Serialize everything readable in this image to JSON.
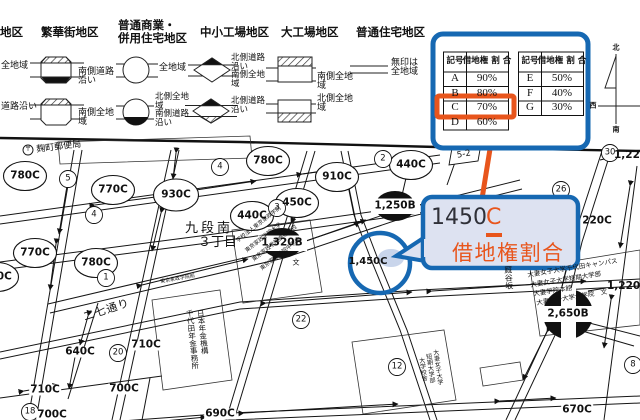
{
  "colors": {
    "accent_blue": "#1668b2",
    "accent_orange": "#e8551c",
    "callout_fill": "#dde2f1"
  },
  "legend": {
    "col0": {
      "title": "高度商業地区",
      "label_a": "全地域",
      "label_b": "道路沿い"
    },
    "col1": {
      "title": "繁華街地区",
      "label_a": "南側道路\n沿い",
      "label_b": "南側全地\n域"
    },
    "col2": {
      "title": "普通商業・\n併用住宅地区",
      "label_a": "全地域",
      "label_b": "北側全地\n域\n南側道路\n沿い"
    },
    "col3": {
      "title": "中小工場地区",
      "label_a": "北側道路\n沿い\n南側全地\n域",
      "label_b": "北側道路\n沿い"
    },
    "col4": {
      "title": "大工場地区",
      "label_a": "南側全地\n域",
      "label_b": "北側全地\n域"
    },
    "col5": {
      "title": "普通住宅地区",
      "label_a": "無印は\n全地域"
    }
  },
  "table": {
    "sym_header": "記号",
    "ratio_header": "借地権\n割 合",
    "highlighted_symbol": "C",
    "rows_left": [
      {
        "sym": "A",
        "ratio": "90%"
      },
      {
        "sym": "B",
        "ratio": "80%"
      },
      {
        "sym": "C",
        "ratio": "70%"
      },
      {
        "sym": "D",
        "ratio": "60%"
      }
    ],
    "rows_right": [
      {
        "sym": "E",
        "ratio": "50%"
      },
      {
        "sym": "F",
        "ratio": "40%"
      },
      {
        "sym": "G",
        "ratio": "30%"
      }
    ]
  },
  "compass": {
    "n": "北",
    "w": "西",
    "s": "南"
  },
  "callout": {
    "value": "1450",
    "symbol": "C",
    "label": "借地権割合"
  },
  "map": {
    "values": [
      {
        "t": "780C"
      },
      {
        "t": "770C"
      },
      {
        "t": "930C"
      },
      {
        "t": "780C"
      },
      {
        "t": "440C"
      },
      {
        "t": "910C"
      },
      {
        "t": "450C"
      },
      {
        "t": "440C"
      },
      {
        "t": "770C"
      },
      {
        "t": "780C"
      },
      {
        "t": "1,320B"
      },
      {
        "t": "1,250B"
      },
      {
        "t": "1,450C"
      },
      {
        "t": "220C"
      },
      {
        "t": "1,220C"
      },
      {
        "t": "1,220C"
      },
      {
        "t": "2,650B"
      },
      {
        "t": "640C"
      },
      {
        "t": "710C"
      },
      {
        "t": "710C"
      },
      {
        "t": "700C"
      },
      {
        "t": "700C"
      },
      {
        "t": "690C"
      },
      {
        "t": "670C"
      },
      {
        "t": "700C"
      }
    ],
    "blocks": [
      {
        "n": "5"
      },
      {
        "n": "4"
      },
      {
        "n": "4"
      },
      {
        "n": "3"
      },
      {
        "n": "2"
      },
      {
        "n": "1"
      },
      {
        "n": "30"
      },
      {
        "n": "26"
      },
      {
        "n": "20"
      },
      {
        "n": "18"
      },
      {
        "n": "22"
      },
      {
        "n": "12"
      },
      {
        "n": "8"
      },
      {
        "n": "5-2"
      }
    ],
    "labels": [
      {
        "t": "麹町郵便局"
      },
      {
        "t": "〒"
      },
      {
        "t": "九段南"
      },
      {
        "t": "３丁目"
      },
      {
        "t": "二七通り"
      },
      {
        "t": "厩谷坂"
      },
      {
        "t": "東京家政学院前"
      },
      {
        "t": "学校法人東京家政学院"
      },
      {
        "t": "東京家政学院大学"
      },
      {
        "t": "東京家政学院高等学校"
      },
      {
        "t": "東京家政学院中学校"
      },
      {
        "t": "文"
      },
      {
        "t": "日本年金機構"
      },
      {
        "t": "千代田年金事務所"
      },
      {
        "t": "大妻女子大学千代田キャンパス"
      },
      {
        "t": "大妻女子大学短期大学部"
      },
      {
        "t": "大妻学院本館"
      },
      {
        "t": "大妻女子大学大学院　文"
      },
      {
        "t": "大妻女子大学"
      },
      {
        "t": "短期大学部"
      },
      {
        "t": "大学校舎"
      }
    ]
  }
}
